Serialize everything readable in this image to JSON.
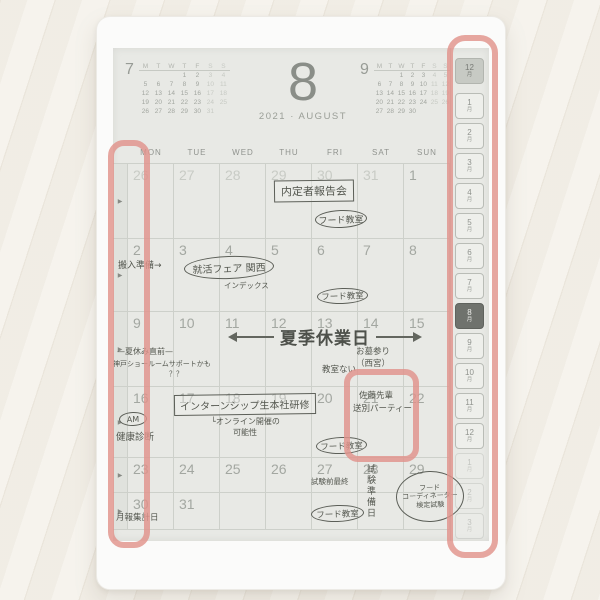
{
  "colors": {
    "annotation_red": "#e0928b",
    "screen_background": "#e8e9e5",
    "ink": "#54574f",
    "grid_line": "#cdd0ca"
  },
  "header": {
    "prev_month_label": "7",
    "next_month_label": "9",
    "big_month": "8",
    "year": "2021",
    "separator": "·",
    "month_name": "AUGUST",
    "mini_day_letters": [
      "M",
      "T",
      "W",
      "T",
      "F",
      "S",
      "S"
    ],
    "prev_weeks": [
      [
        "",
        "",
        "",
        "1",
        "2",
        "3",
        "4"
      ],
      [
        "5",
        "6",
        "7",
        "8",
        "9",
        "10",
        "11"
      ],
      [
        "12",
        "13",
        "14",
        "15",
        "16",
        "17",
        "18"
      ],
      [
        "19",
        "20",
        "21",
        "22",
        "23",
        "24",
        "25"
      ],
      [
        "26",
        "27",
        "28",
        "29",
        "30",
        "31",
        ""
      ]
    ],
    "next_weeks": [
      [
        "",
        "",
        "1",
        "2",
        "3",
        "4",
        "5"
      ],
      [
        "6",
        "7",
        "8",
        "9",
        "10",
        "11",
        "12"
      ],
      [
        "13",
        "14",
        "15",
        "16",
        "17",
        "18",
        "19"
      ],
      [
        "20",
        "21",
        "22",
        "23",
        "24",
        "25",
        "26"
      ],
      [
        "27",
        "28",
        "29",
        "30",
        "",
        "",
        ""
      ]
    ]
  },
  "weekday_headers": [
    "MON",
    "TUE",
    "WED",
    "THU",
    "FRI",
    "SAT",
    "SUN"
  ],
  "weeks": [
    {
      "dates": [
        "26",
        "27",
        "28",
        "29",
        "30",
        "31",
        "1"
      ],
      "muted": [
        true,
        true,
        true,
        true,
        true,
        true,
        false
      ]
    },
    {
      "dates": [
        "2",
        "3",
        "4",
        "5",
        "6",
        "7",
        "8"
      ],
      "muted": [
        false,
        false,
        false,
        false,
        false,
        false,
        false
      ]
    },
    {
      "dates": [
        "9",
        "10",
        "11",
        "12",
        "13",
        "14",
        "15"
      ],
      "muted": [
        false,
        false,
        false,
        false,
        false,
        false,
        false
      ]
    },
    {
      "dates": [
        "16",
        "17",
        "18",
        "19",
        "20",
        "21",
        "22"
      ],
      "muted": [
        false,
        false,
        false,
        false,
        false,
        false,
        false
      ]
    },
    {
      "dates": [
        "23",
        "24",
        "25",
        "26",
        "27",
        "28",
        "29"
      ],
      "muted": [
        false,
        false,
        false,
        false,
        false,
        false,
        false
      ]
    },
    {
      "dates": [
        "30",
        "31",
        "",
        "",
        "",
        "",
        ""
      ],
      "muted": [
        false,
        false,
        false,
        false,
        false,
        false,
        false
      ]
    }
  ],
  "month_tabs": {
    "suffix": "月",
    "items": [
      {
        "num": "12",
        "state": "gray"
      },
      {
        "num": "1",
        "state": "normal"
      },
      {
        "num": "2",
        "state": "normal"
      },
      {
        "num": "3",
        "state": "normal"
      },
      {
        "num": "4",
        "state": "normal"
      },
      {
        "num": "5",
        "state": "normal"
      },
      {
        "num": "6",
        "state": "normal"
      },
      {
        "num": "7",
        "state": "normal"
      },
      {
        "num": "8",
        "state": "selected"
      },
      {
        "num": "9",
        "state": "normal"
      },
      {
        "num": "10",
        "state": "normal"
      },
      {
        "num": "11",
        "state": "normal"
      },
      {
        "num": "12",
        "state": "normal"
      },
      {
        "num": "1",
        "state": "faded"
      },
      {
        "num": "2",
        "state": "faded"
      },
      {
        "num": "3",
        "state": "faded"
      }
    ]
  },
  "notes": {
    "w1_meeting": {
      "text": "内定者報告会"
    },
    "w1_food": {
      "text": "フード教室"
    },
    "w2_prep": {
      "text": "搬入準備→"
    },
    "w2_fair": {
      "text": "就活フェア 関西"
    },
    "w2_index": {
      "text": "インデックス"
    },
    "w2_food": {
      "text": "フード教室"
    },
    "w3_holiday": {
      "text": "夏季休業日"
    },
    "w3_before": {
      "text": "—夏休み直前—"
    },
    "w3_showroom": {
      "lines": [
        "神戸ショールームサポートかも",
        "？？"
      ]
    },
    "w3_noclass": {
      "text": "教室ない"
    },
    "w3_grave": {
      "lines": [
        "お墓参り",
        "（西宮）"
      ]
    },
    "w4_am": {
      "text": "AM"
    },
    "w4_checkup": {
      "text": "健康診断"
    },
    "w4_intern": {
      "text": "インターンシップ生本社研修"
    },
    "w4_online": {
      "lines": [
        "└オンライン開催の",
        "可能性"
      ]
    },
    "w4_food": {
      "text": "フード教室"
    },
    "w4_party": {
      "lines": [
        "佐藤先輩",
        "送別パーティー"
      ]
    },
    "w5_final": {
      "text": "試験前最終"
    },
    "w5_food": {
      "text": "フード教室"
    },
    "w5_prep": {
      "text": "試験準備日"
    },
    "w5_exam": {
      "lines": [
        "フード",
        "コーディネーター",
        "検定試験"
      ]
    },
    "w6_report": {
      "text": "月報集計日"
    }
  },
  "annotations": {
    "color": "#e0928b",
    "boxes": [
      "left-week-select-column",
      "month-tab-strip",
      "august-21-cell"
    ]
  }
}
